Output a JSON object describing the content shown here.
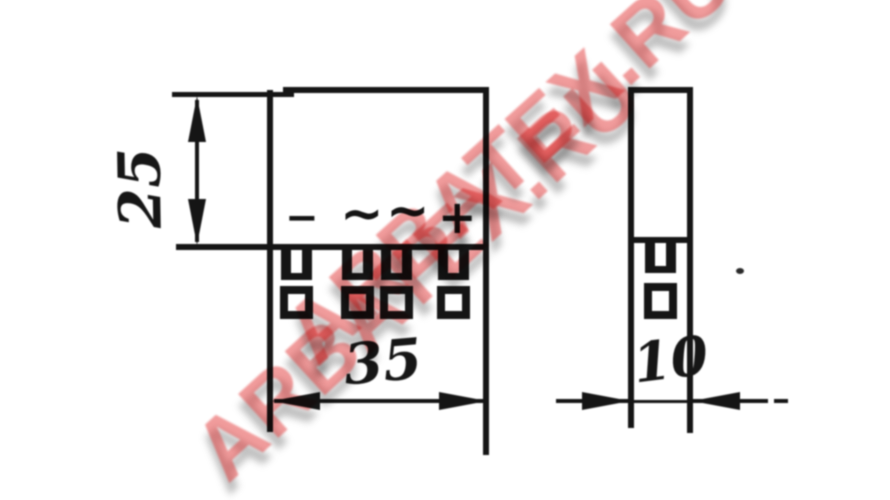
{
  "drawing": {
    "type": "technical-dimensional-drawing",
    "front_view": {
      "height_dim": "25",
      "width_dim": "35",
      "terminals": [
        "−",
        "~",
        "~",
        "+"
      ]
    },
    "side_view": {
      "depth_dim": "10"
    }
  },
  "watermark": {
    "text": "ARBATEX.RU",
    "color": "rgba(228,58,58,0.5)"
  }
}
